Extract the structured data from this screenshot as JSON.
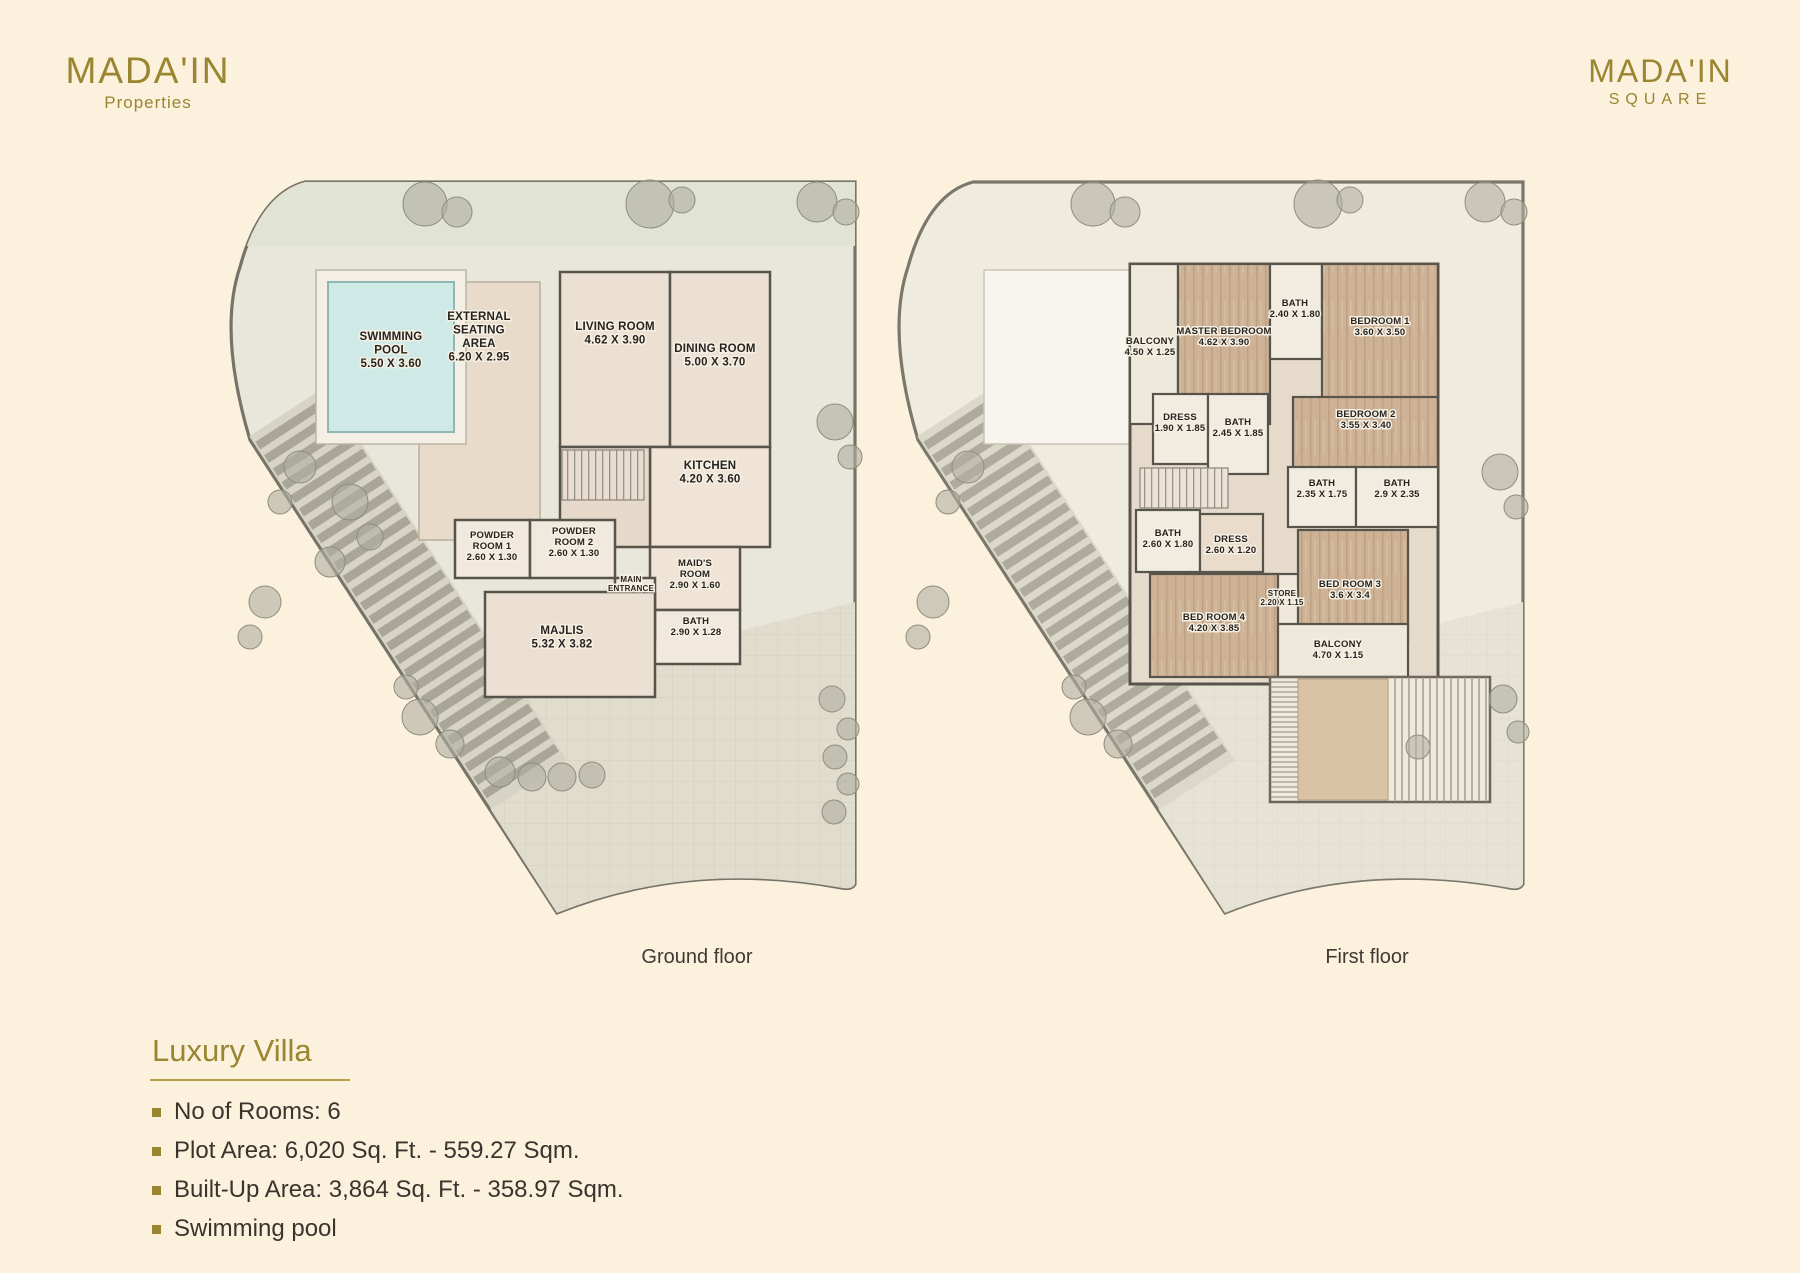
{
  "brand_left": {
    "name": "MADA'IN",
    "tagline": "Properties"
  },
  "brand_right": {
    "name": "MADA'IN",
    "tagline": "SQUARE"
  },
  "plans": [
    {
      "id": "ground",
      "caption": "Ground floor",
      "rooms": [
        {
          "id": "swimming_pool",
          "lines": [
            "SWIMMING",
            "POOL",
            "5.50 X 3.60"
          ]
        },
        {
          "id": "external_seating",
          "lines": [
            "EXTERNAL",
            "SEATING",
            "AREA",
            "6.20 X 2.95"
          ]
        },
        {
          "id": "living_room",
          "lines": [
            "LIVING ROOM",
            "4.62 X 3.90"
          ]
        },
        {
          "id": "dining_room",
          "lines": [
            "DINING ROOM",
            "5.00 X 3.70"
          ]
        },
        {
          "id": "kitchen",
          "lines": [
            "KITCHEN",
            "4.20 X 3.60"
          ]
        },
        {
          "id": "powder_room_1",
          "lines": [
            "POWDER",
            "ROOM 1",
            "2.60 X 1.30"
          ]
        },
        {
          "id": "powder_room_2",
          "lines": [
            "POWDER",
            "ROOM 2",
            "2.60 X 1.30"
          ]
        },
        {
          "id": "maids_room",
          "lines": [
            "MAID'S",
            "ROOM",
            "2.90 X 1.60"
          ]
        },
        {
          "id": "main_entrance",
          "lines": [
            "MAIN",
            "ENTRANCE"
          ]
        },
        {
          "id": "bath",
          "lines": [
            "BATH",
            "2.90 X 1.28"
          ]
        },
        {
          "id": "majlis",
          "lines": [
            "MAJLIS",
            "5.32 X 3.82"
          ]
        }
      ]
    },
    {
      "id": "first",
      "caption": "First floor",
      "rooms": [
        {
          "id": "balcony_left",
          "lines": [
            "BALCONY",
            "4.50 X 1.25"
          ]
        },
        {
          "id": "master_bedroom",
          "lines": [
            "MASTER BEDROOM",
            "4.62 X 3.90"
          ]
        },
        {
          "id": "bath_top",
          "lines": [
            "BATH",
            "2.40 X 1.80"
          ]
        },
        {
          "id": "bedroom_1",
          "lines": [
            "BEDROOM 1",
            "3.60 X 3.50"
          ]
        },
        {
          "id": "dress_1",
          "lines": [
            "DRESS",
            "1.90 X 1.85"
          ]
        },
        {
          "id": "bath_2",
          "lines": [
            "BATH",
            "2.45 X 1.85"
          ]
        },
        {
          "id": "bedroom_2",
          "lines": [
            "BEDROOM 2",
            "3.55 X 3.40"
          ]
        },
        {
          "id": "bath_3",
          "lines": [
            "BATH",
            "2.35 X 1.75"
          ]
        },
        {
          "id": "bath_4",
          "lines": [
            "BATH",
            "2.9 X 2.35"
          ]
        },
        {
          "id": "bath_5",
          "lines": [
            "BATH",
            "2.60 X 1.80"
          ]
        },
        {
          "id": "dress_2",
          "lines": [
            "DRESS",
            "2.60 X 1.20"
          ]
        },
        {
          "id": "store",
          "lines": [
            "STORE",
            "2.20 X 1.15"
          ]
        },
        {
          "id": "bed_room_3",
          "lines": [
            "BED ROOM 3",
            "3.6 X 3.4"
          ]
        },
        {
          "id": "bed_room_4",
          "lines": [
            "BED ROOM 4",
            "4.20 X 3.85"
          ]
        },
        {
          "id": "balcony_bottom",
          "lines": [
            "BALCONY",
            "4.70 X 1.15"
          ]
        }
      ]
    }
  ],
  "details": {
    "title": "Luxury Villa",
    "bullets": [
      "No of Rooms: 6",
      "Plot Area: 6,020 Sq. Ft. - 559.27 Sqm.",
      "Built-Up Area: 3,864 Sq. Ft. - 358.97 Sqm.",
      "Swimming pool"
    ]
  },
  "colors": {
    "background": "#fbf1dc",
    "gold": "#9a8530",
    "text": "#39342e",
    "pool": "#cfe9e7",
    "wood": "#cdb296",
    "wall": "#57544c"
  }
}
